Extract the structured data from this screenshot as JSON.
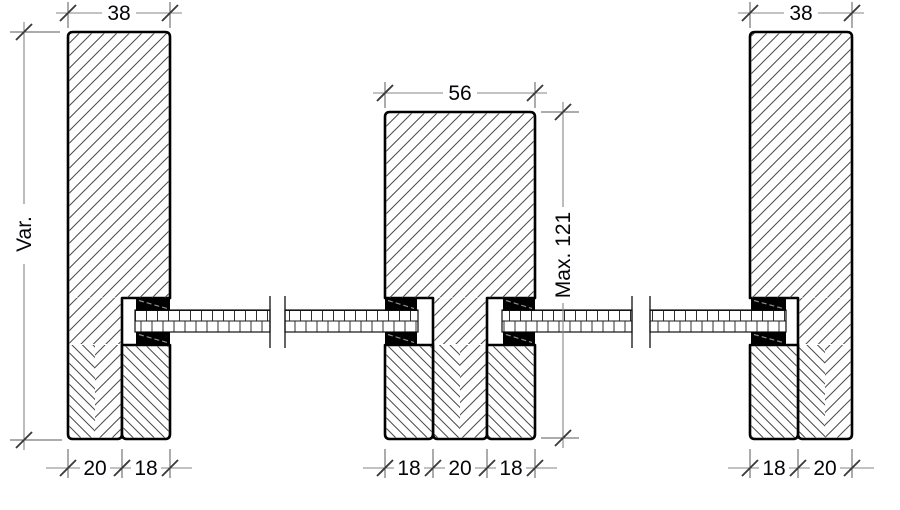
{
  "drawing": {
    "title": "Timber glazing partition section detail",
    "labels": {
      "top": {
        "left": "38",
        "middle": "56",
        "right": "38"
      },
      "side": {
        "left": "Var.",
        "middle": "Max. 121"
      },
      "bottom": {
        "left": [
          "20",
          "18"
        ],
        "middle": [
          "18",
          "20",
          "18"
        ],
        "right": [
          "18",
          "20"
        ]
      }
    },
    "colors": {
      "background": "#ffffff",
      "outline": "#000000",
      "hatch": "#4a4a4a",
      "gasket_fill": "#000000",
      "gasket_dash": "#8f8f8f",
      "dimension_line": "#868686",
      "extension_line": "#5a5a5a",
      "text": "#05050a"
    }
  }
}
